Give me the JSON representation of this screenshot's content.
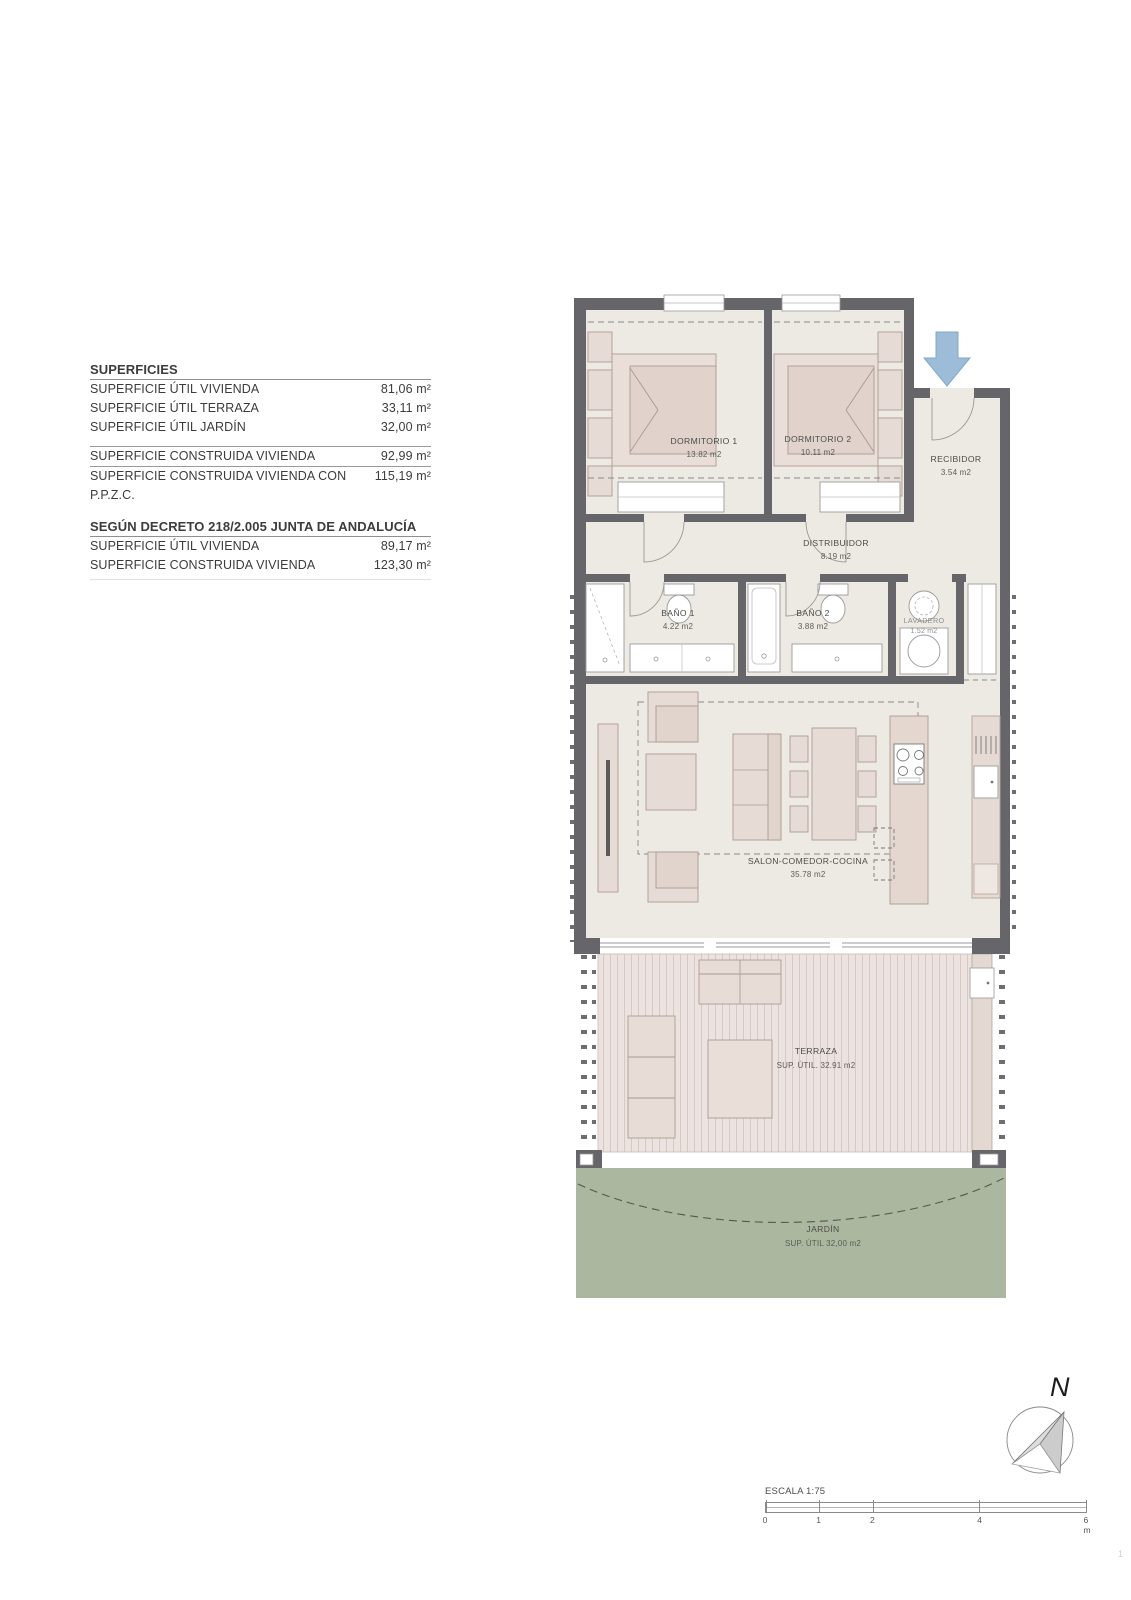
{
  "surfaces_table": {
    "title": "SUPERFICIES",
    "rows_util": [
      {
        "label": "SUPERFICIE ÚTIL VIVIENDA",
        "value": "81,06 m²"
      },
      {
        "label": "SUPERFICIE ÚTIL TERRAZA",
        "value": "33,11 m²"
      },
      {
        "label": "SUPERFICIE ÚTIL JARDÍN",
        "value": "32,00 m²"
      }
    ],
    "rows_construida": [
      {
        "label": "SUPERFICIE CONSTRUIDA VIVIENDA",
        "value": "92,99 m²"
      },
      {
        "label": "SUPERFICIE CONSTRUIDA VIVIENDA CON P.P.Z.C.",
        "value": "115,19 m²"
      }
    ],
    "decree_title": "SEGÚN DECRETO 218/2.005 JUNTA DE ANDALUCÍA",
    "rows_decree": [
      {
        "label": "SUPERFICIE ÚTIL VIVIENDA",
        "value": "89,17 m²"
      },
      {
        "label": "SUPERFICIE CONSTRUIDA VIVIENDA",
        "value": "123,30 m²"
      }
    ]
  },
  "plan": {
    "rooms": {
      "dormitorio1": {
        "name": "DORMITORIO 1",
        "area": "13.82 m2"
      },
      "dormitorio2": {
        "name": "DORMITORIO 2",
        "area": "10.11 m2"
      },
      "recibidor": {
        "name": "RECIBIDOR",
        "area": "3.54 m2"
      },
      "distribuidor": {
        "name": "DISTRIBUIDOR",
        "area": "8.19 m2"
      },
      "bano1": {
        "name": "BAÑO 1",
        "area": "4.22 m2"
      },
      "bano2": {
        "name": "BAÑO 2",
        "area": "3.88 m2"
      },
      "lavadero": {
        "name": "LAVADERO",
        "area": "1.52 m2"
      },
      "salon": {
        "name": "SALON-COMEDOR-COCINA",
        "area": "35.78 m2"
      },
      "terraza": {
        "name": "TERRAZA",
        "area": "SUP. ÚTIL. 32.91 m2"
      },
      "jardin": {
        "name": "JARDÍN",
        "area": "SUP. ÚTIL 32,00 m2"
      }
    },
    "colors": {
      "wall": "#66666a",
      "floor": "#edeae3",
      "furniture": "#e6dcd5",
      "deck": "#ece3e0",
      "garden": "#abb79e",
      "entrance_arrow": "#9dbcd7"
    }
  },
  "compass": {
    "north_label": "N"
  },
  "scale": {
    "label": "ESCALA 1:75",
    "ticks": [
      "0",
      "1",
      "2",
      "4",
      "6 m"
    ]
  },
  "page_number": "1"
}
